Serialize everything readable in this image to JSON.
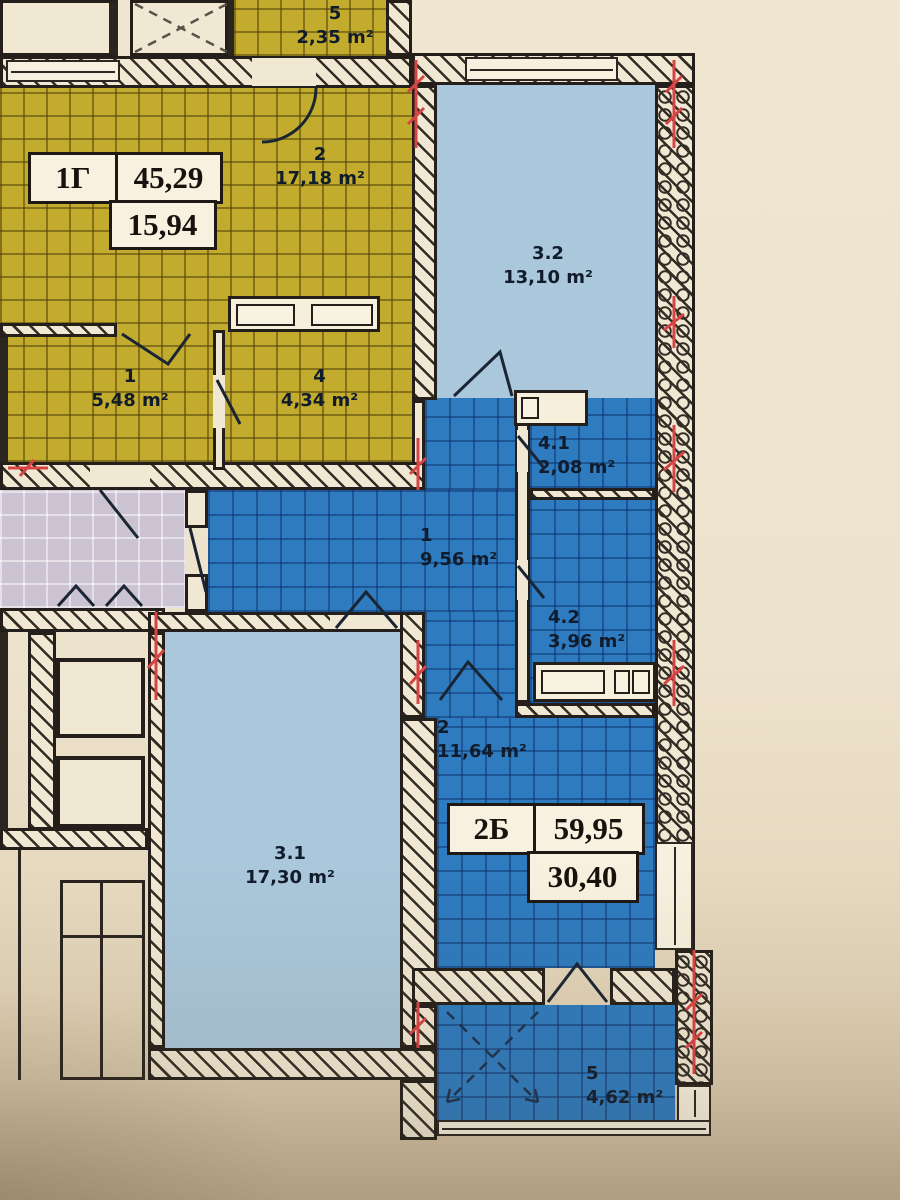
{
  "plan": {
    "apartment_1g": {
      "code": "1Г",
      "total_area": "45,29",
      "living_area": "15,94",
      "rooms": {
        "r1": {
          "id": "1",
          "area": "5,48 m²"
        },
        "r2": {
          "id": "2",
          "area": "17,18 m²"
        },
        "r4": {
          "id": "4",
          "area": "4,34 m²"
        },
        "r5": {
          "id": "5",
          "area": "2,35 m²"
        }
      }
    },
    "apartment_2b": {
      "code": "2Б",
      "total_area": "59,95",
      "living_area": "30,40",
      "rooms": {
        "r1": {
          "id": "1",
          "area": "9,56 m²"
        },
        "r2": {
          "id": "2",
          "area": "11,64 m²"
        },
        "r31": {
          "id": "3.1",
          "area": "17,30 m²"
        },
        "r32": {
          "id": "3.2",
          "area": "13,10 m²"
        },
        "r41": {
          "id": "4.1",
          "area": "2,08 m²"
        },
        "r42": {
          "id": "4.2",
          "area": "3,96 m²"
        },
        "r5": {
          "id": "5",
          "area": "4,62 m²"
        }
      }
    },
    "colors": {
      "apartment_1g_fill": "#c2ab2d",
      "apartment_2b_fill": "#2e7bbf",
      "secondary_room_fill": "#aac7db",
      "common_corridor_fill": "#cbc2d2",
      "wall_fill": "#f1e8d3",
      "background": "#ece1cb",
      "section_mark": "#d84444",
      "line": "#231d17"
    }
  }
}
